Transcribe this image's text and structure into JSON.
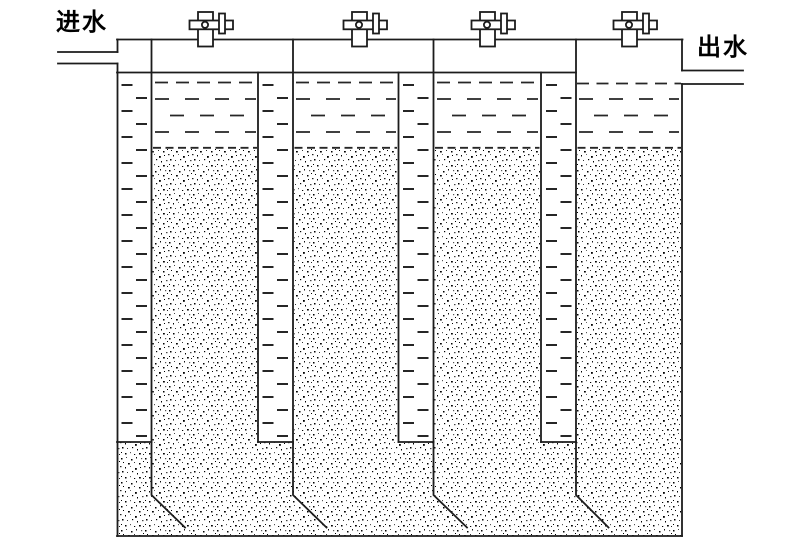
{
  "diagram": {
    "kind": "multi-cell upflow filter cross-section drawing",
    "labels": {
      "inlet": "进水",
      "outlet": "出水"
    },
    "colors": {
      "line": "#1c1c1c",
      "water_dash": "#262626",
      "media_dot": "#111111",
      "background": "#ffffff"
    },
    "counts": {
      "top_valves": 4,
      "filter_cells": 4,
      "downcomer_channels": 4
    },
    "valves": [
      {
        "name": "valve-1"
      },
      {
        "name": "valve-2"
      },
      {
        "name": "valve-3"
      },
      {
        "name": "valve-4"
      }
    ]
  }
}
